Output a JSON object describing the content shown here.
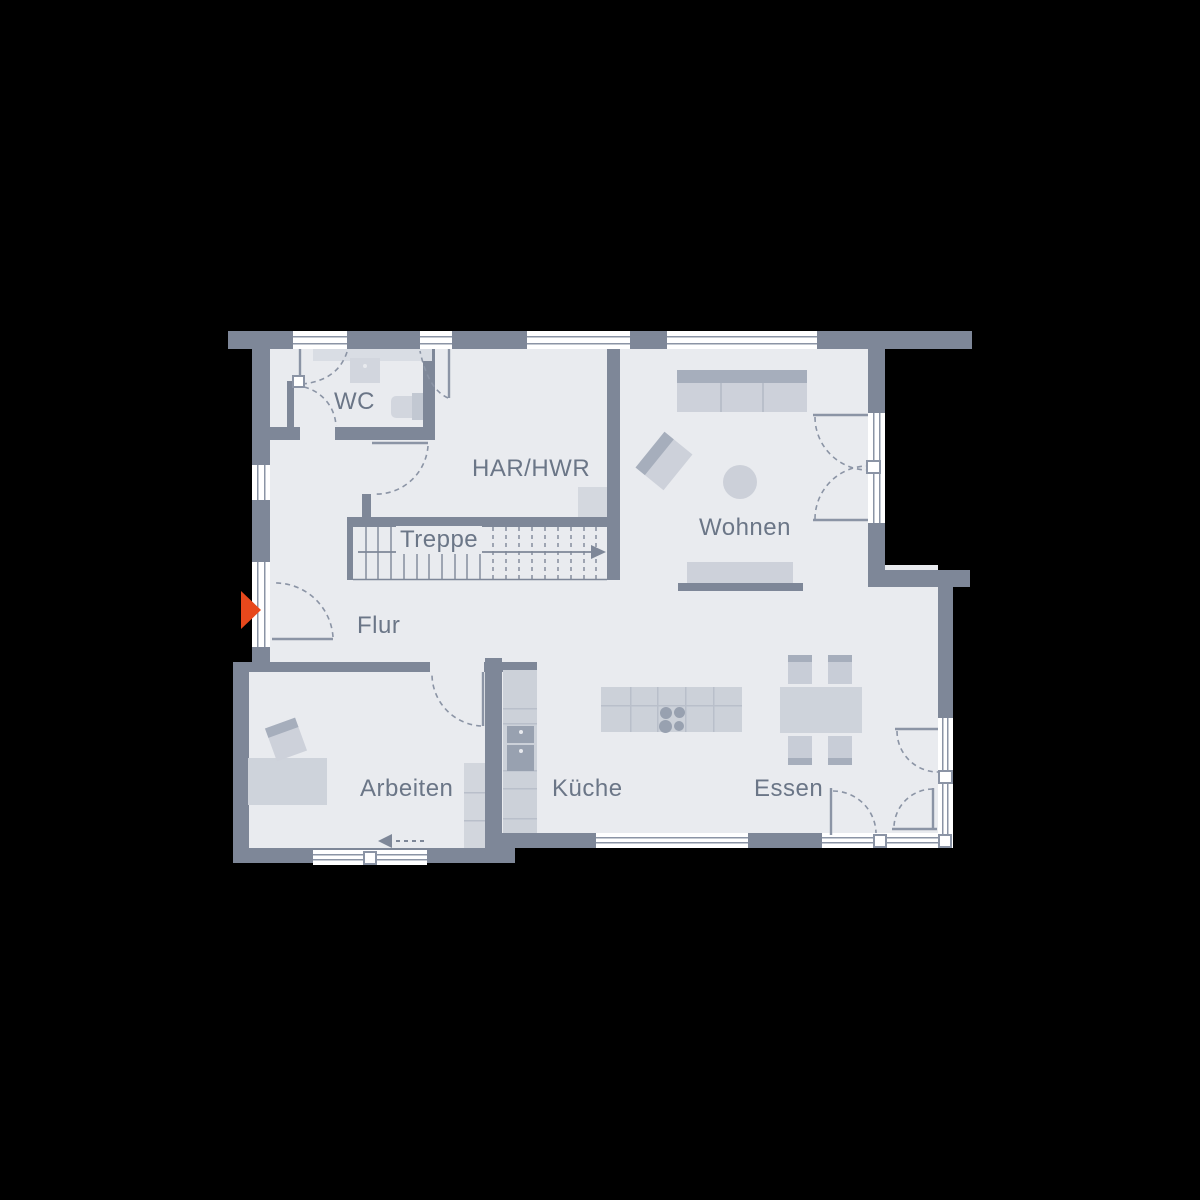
{
  "rooms": [
    {
      "id": "wc",
      "label": "WC"
    },
    {
      "id": "har_hwr",
      "label": "HAR/HWR"
    },
    {
      "id": "treppe",
      "label": "Treppe"
    },
    {
      "id": "wohnen",
      "label": "Wohnen"
    },
    {
      "id": "flur",
      "label": "Flur"
    },
    {
      "id": "arbeiten",
      "label": "Arbeiten"
    },
    {
      "id": "kueche",
      "label": "Küche"
    },
    {
      "id": "essen",
      "label": "Essen"
    }
  ],
  "markers": {
    "entrance_icon": "entry-arrow"
  },
  "colors": {
    "bg": "#000000",
    "floor": "#e9ebef",
    "wall": "#7e8798",
    "line": "#8b94a5",
    "furn": "#cdd1da",
    "furn2": "#ced3db",
    "furndark": "#a6aebc",
    "appliance": "#98a1b0",
    "gridline": "#b9bfca",
    "label": "#6b7687",
    "accent": "#e8481c"
  }
}
